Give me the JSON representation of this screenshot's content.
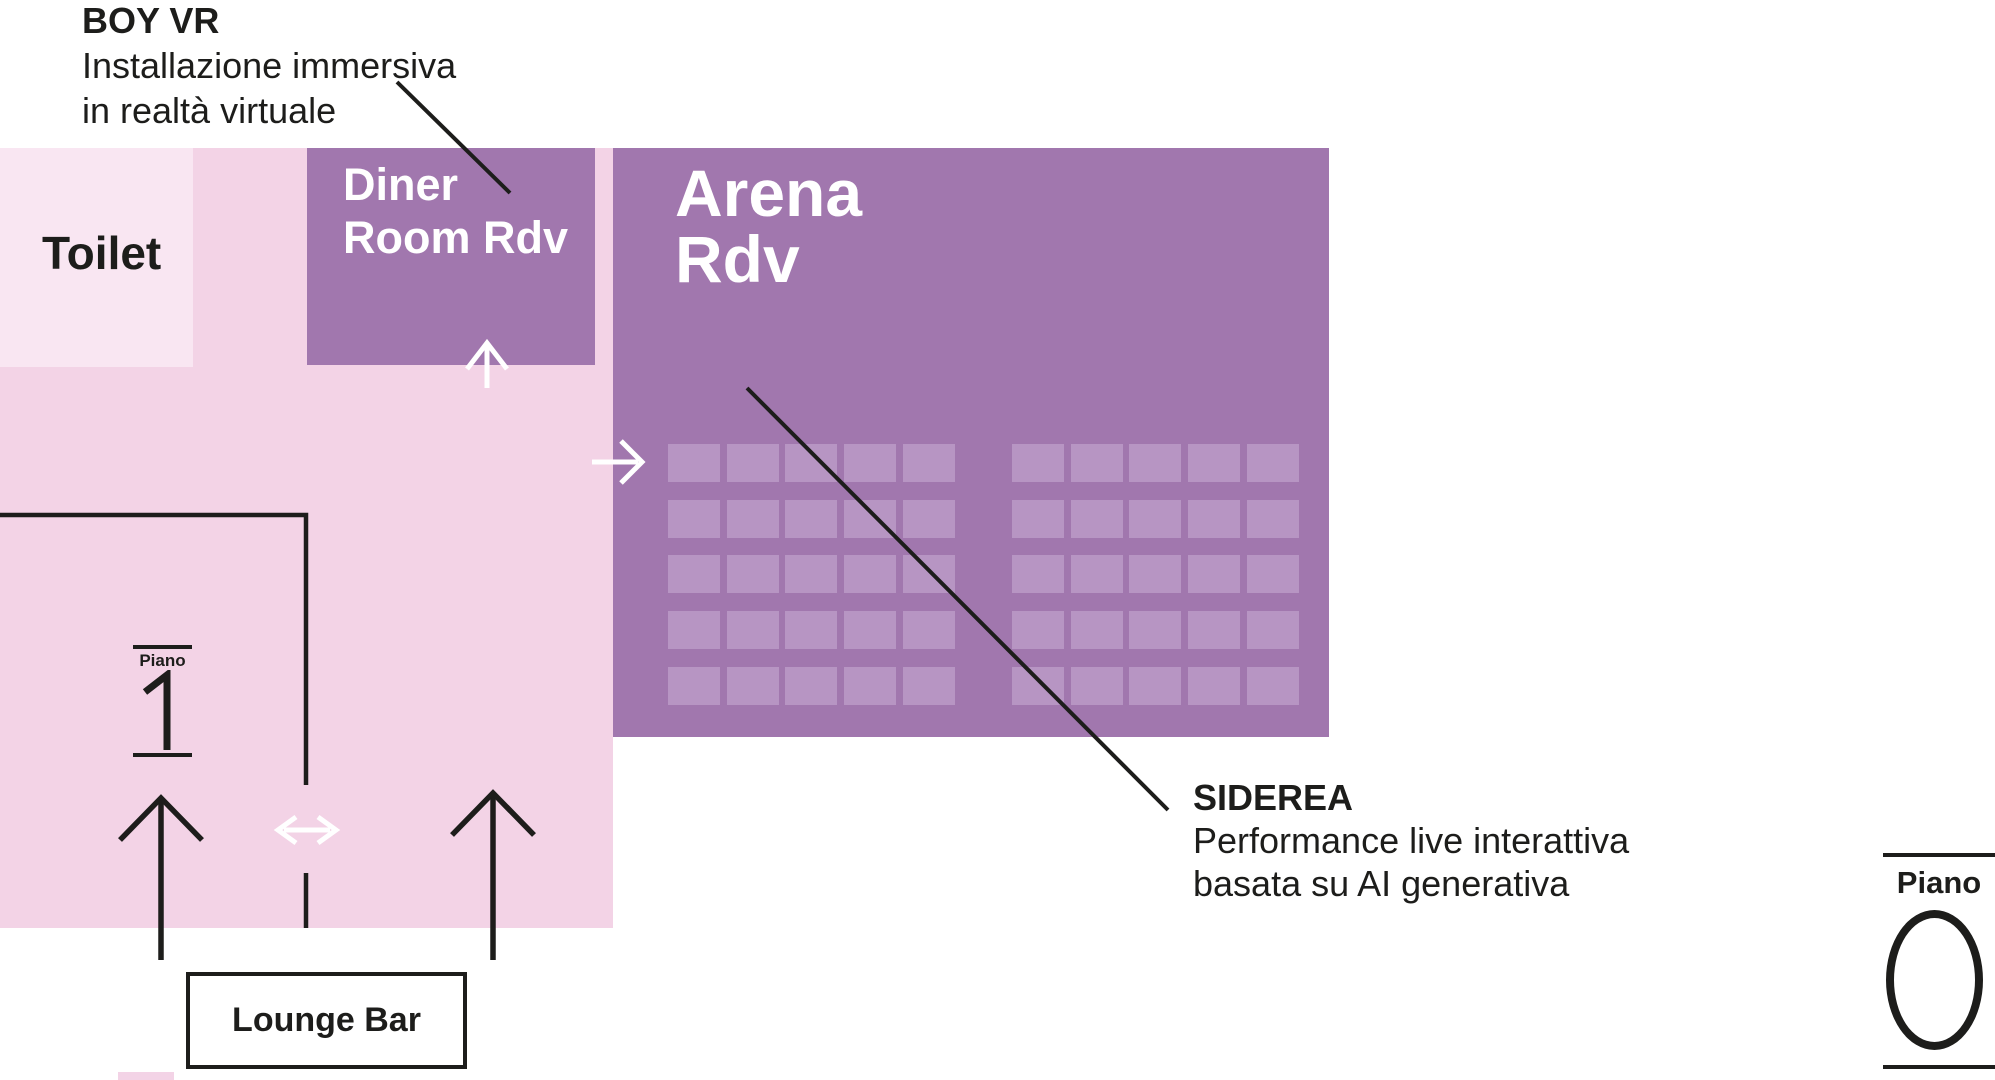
{
  "window": {
    "width": 1995,
    "height": 1080
  },
  "colors": {
    "background": "#ffffff",
    "floor_pink": "#f3d3e6",
    "toilet_pink": "#f9e6f2",
    "room_purple": "#a177ae",
    "seat_purple": "#b795c3",
    "ink": "#1d1d1b",
    "arrow_white": "#ffffff"
  },
  "annotations": {
    "boy_vr": {
      "title": "BOY VR",
      "description_line1": "Installazione immersiva",
      "description_line2": "in realtà virtuale"
    },
    "siderea": {
      "title": "SIDEREA",
      "description_line1": "Performance live interattiva",
      "description_line2": "basata su AI generativa"
    }
  },
  "rooms": {
    "toilet": {
      "label": "Toilet"
    },
    "diner_room": {
      "line1": "Diner",
      "line2": "Room",
      "line3": "Rdv"
    },
    "arena": {
      "line1": "Arena",
      "line2": "Rdv"
    },
    "lounge_bar": {
      "label": "Lounge Bar"
    }
  },
  "floor_indicators": {
    "current_floor": {
      "label": "Piano",
      "number": "0"
    },
    "upper_floor": {
      "label": "Piano",
      "number": "1"
    }
  },
  "seating": {
    "blocks": 2,
    "rows_per_block": 5,
    "cols_per_block": 5,
    "total_seats": 50
  },
  "icons": [
    "up-arrow",
    "right-arrow",
    "double-horizontal-arrow",
    "wall-outline"
  ]
}
